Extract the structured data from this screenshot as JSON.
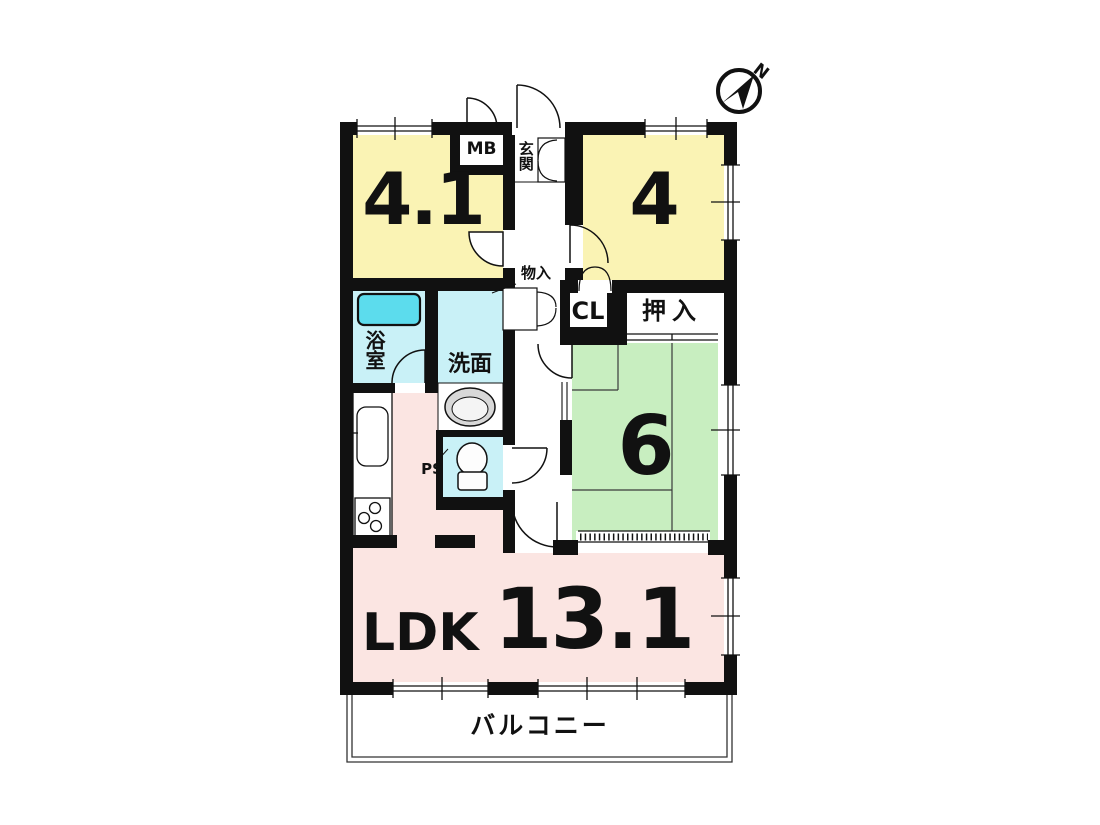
{
  "compass": {
    "label": "N"
  },
  "colors": {
    "wall": "#111111",
    "yellow": "#faf3b4",
    "green": "#c8eec0",
    "pink": "#fbe5e2",
    "cyan": "#c9f1f7",
    "tub": "#5cdced",
    "gray": "#d8d8d8"
  },
  "rooms": {
    "western1": {
      "size": "4.1"
    },
    "western2": {
      "size": "4"
    },
    "japanese": {
      "size": "6"
    },
    "ldk": {
      "name": "LDK",
      "size": "13.1"
    },
    "balcony": {
      "name": "バルコニー"
    },
    "bath": {
      "name": "浴室"
    },
    "washroom": {
      "name": "洗面"
    },
    "entrance": {
      "name": "玄関"
    },
    "meter_box": {
      "name": "MB"
    },
    "closet": {
      "name": "CL"
    },
    "oshiire": {
      "name": "押入"
    },
    "storage": {
      "name": "物入"
    },
    "pipe_space": {
      "name": "PS"
    }
  }
}
